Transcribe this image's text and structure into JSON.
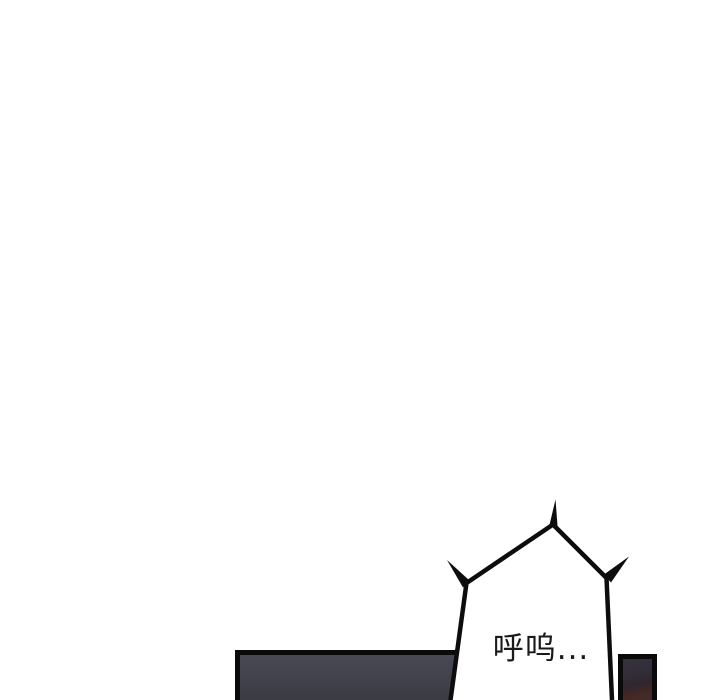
{
  "page": {
    "type": "webtoon-comic-strip",
    "background": "#ffffff"
  },
  "bubble": {
    "text": "呼呜...",
    "fill": "#ffffff",
    "outline": "#0d0d0d",
    "text_color": "#1a1a1a"
  },
  "panels": {
    "border_ink": "#0a0a0a",
    "left": {
      "fill_top": "#4a4b55",
      "fill_mid": "#41424b",
      "fill_bottom": "#3a3b43"
    },
    "right": {
      "fill_top": "#38353f",
      "fill_mid": "#322d38",
      "fill_lower": "#30262d",
      "fill_maroon": "#3f2726",
      "fill_bottom": "#442b27"
    }
  }
}
